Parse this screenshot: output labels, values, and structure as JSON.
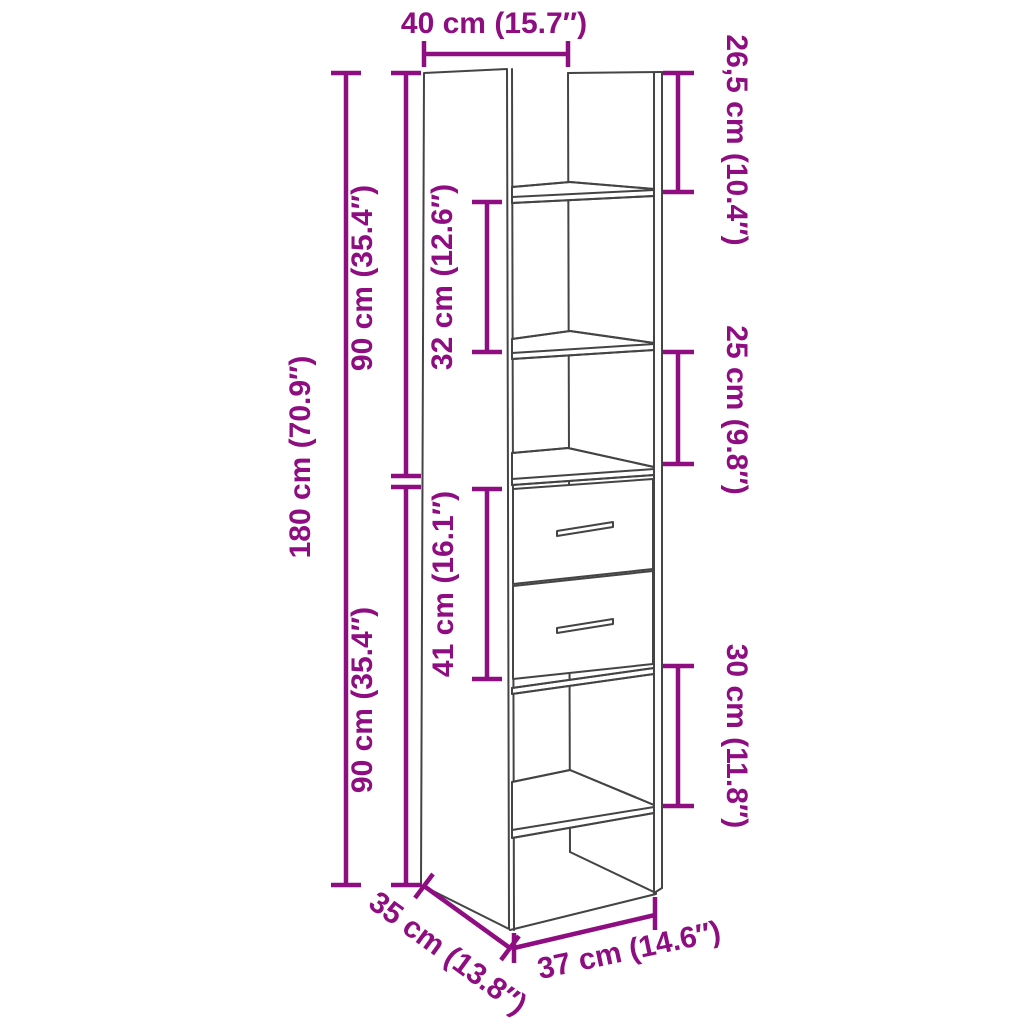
{
  "diagram": {
    "type": "furniture-dimension-diagram",
    "product": "tall-cabinet-with-2-drawers-and-open-shelves",
    "accent_color": "#8e0d80",
    "line_color": "#444444",
    "background_color": "#ffffff",
    "dimensions": {
      "top_width": "40 cm (15.7″)",
      "top_compartment_height": "26,5 cm (10.4″)",
      "upper_section_height": "90 cm (35.4″)",
      "upper_shelf_gap": "32 cm (12.6″)",
      "total_height": "180 cm (70.9″)",
      "middle_compartment_height": "25 cm (9.8″)",
      "drawer_section_height": "41 cm (16.1″)",
      "lower_section_height": "90 cm (35.4″)",
      "lower_compartment_height": "30 cm (11.8″)",
      "depth": "35 cm (13.8″)",
      "bottom_width": "37 cm (14.6″)"
    }
  }
}
